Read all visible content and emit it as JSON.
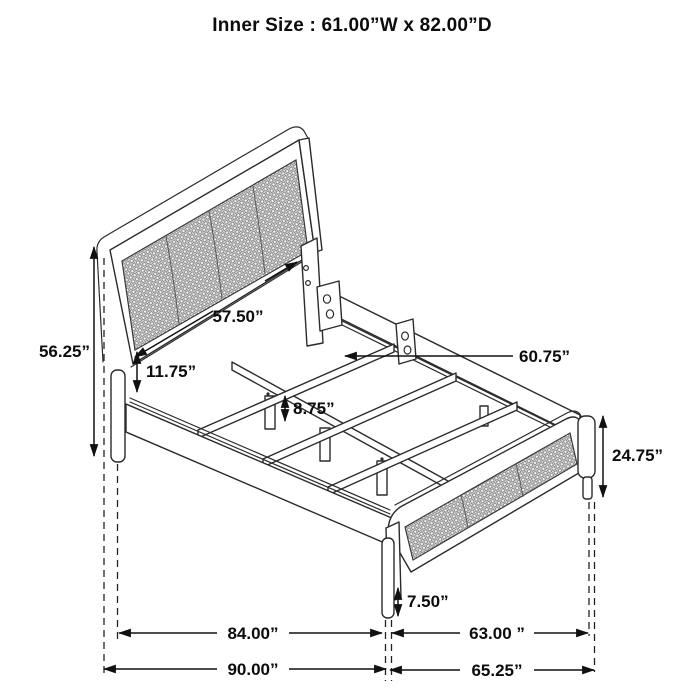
{
  "title": "Inner Size : 61.00”W x 82.00”D",
  "colors": {
    "background": "#ffffff",
    "line_art": "#2b2b2b",
    "dimension_lines": "#111111",
    "mesh": "#8c8c8c",
    "text": "#0c0c0c"
  },
  "dimensions": {
    "headboard_height": "56.25”",
    "headboard_panel_width": "57.50”",
    "panel_to_rail_gap": "11.75”",
    "support_leg_height": "8.75”",
    "slat_length": "60.75”",
    "footboard_height": "24.75”",
    "footboard_clearance": "7.50”",
    "inner_frame_length": "84.00”",
    "overall_length": "90.00”",
    "footboard_inner_width": "63.00 ”",
    "footboard_overall_width": "65.25”"
  }
}
